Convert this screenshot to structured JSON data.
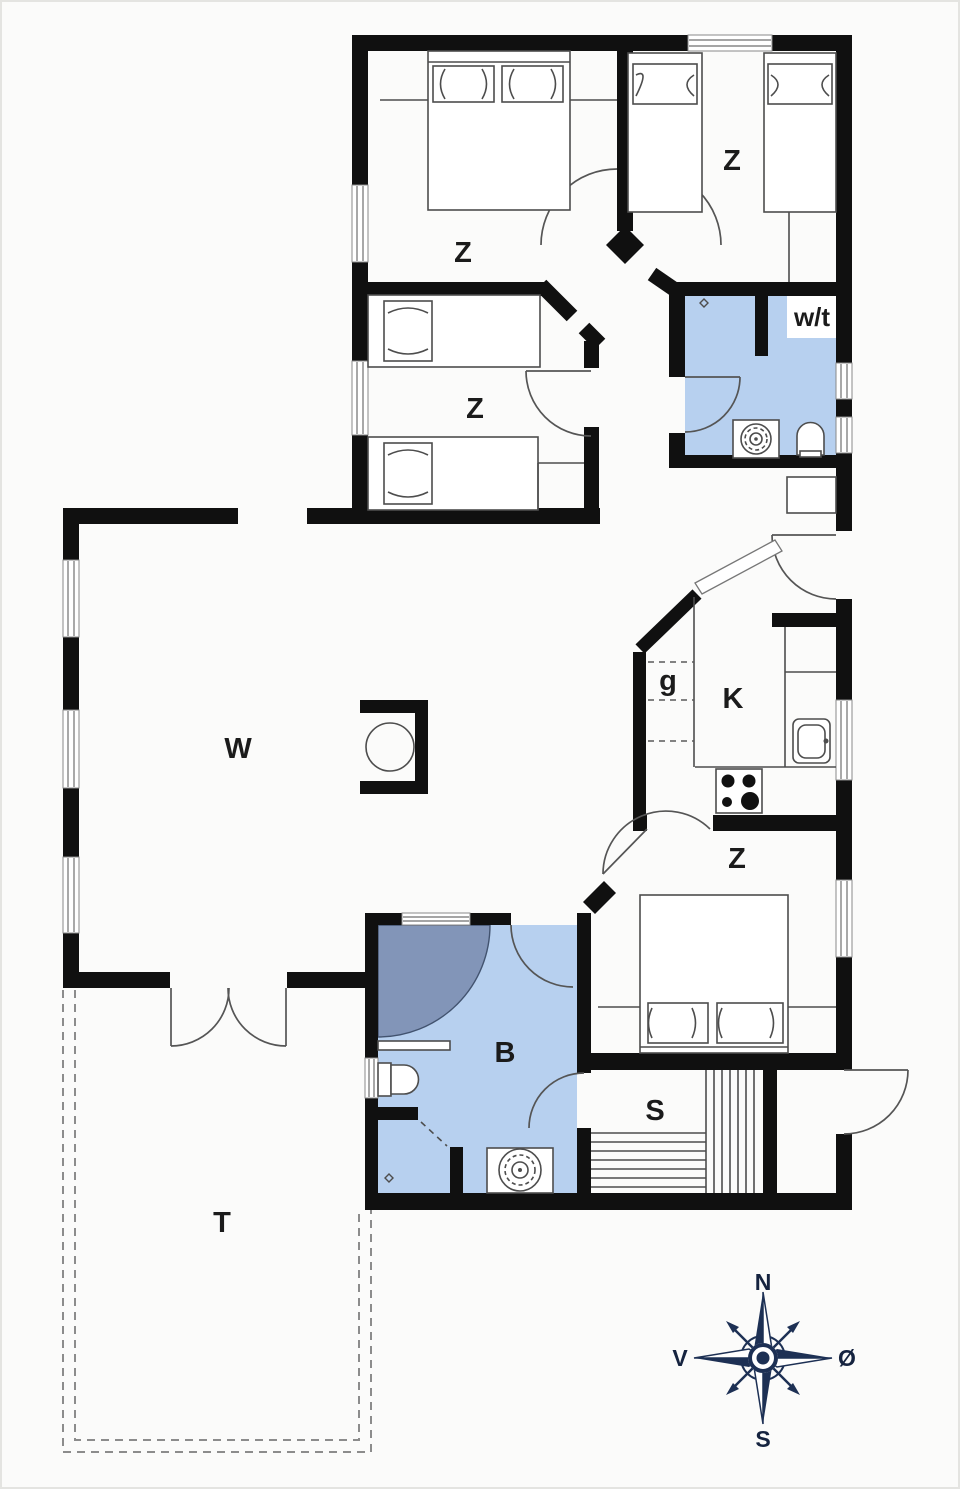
{
  "page": {
    "type": "architectural floor plan drawing"
  },
  "floorplan": {
    "rooms": [
      {
        "id": "bedroom-northwest",
        "label": "Z",
        "type": "bedroom with double bed"
      },
      {
        "id": "bedroom-northeast",
        "label": "Z",
        "type": "bedroom with two single beds"
      },
      {
        "id": "bedroom-west",
        "label": "Z",
        "type": "bedroom with two single beds"
      },
      {
        "id": "bedroom-southeast",
        "label": "Z",
        "type": "bedroom with double bed"
      },
      {
        "id": "living-room",
        "label": "W",
        "type": "living room with wood stove"
      },
      {
        "id": "kitchen",
        "label": "K",
        "type": "kitchen with sink and stove"
      },
      {
        "id": "pantry",
        "label": "g",
        "type": "pantry with shelves"
      },
      {
        "id": "toilet",
        "label": "w/t",
        "type": "washroom / toilet"
      },
      {
        "id": "bathroom",
        "label": "B",
        "type": "bathroom with shower and toilet"
      },
      {
        "id": "sauna",
        "label": "S",
        "type": "sauna with benches"
      },
      {
        "id": "terrace",
        "label": "T",
        "type": "terrace (dashed outline)"
      }
    ],
    "compass": {
      "north": "N",
      "east": "Ø",
      "south": "S",
      "west": "V"
    },
    "colors": {
      "wall": "#101010",
      "wet_room_fill": "#b7d0ef",
      "shower_fill": "#8295b8",
      "furniture_line": "#4d4d4d",
      "compass_navy": "#1d3054",
      "background": "#fbfbfa"
    }
  }
}
